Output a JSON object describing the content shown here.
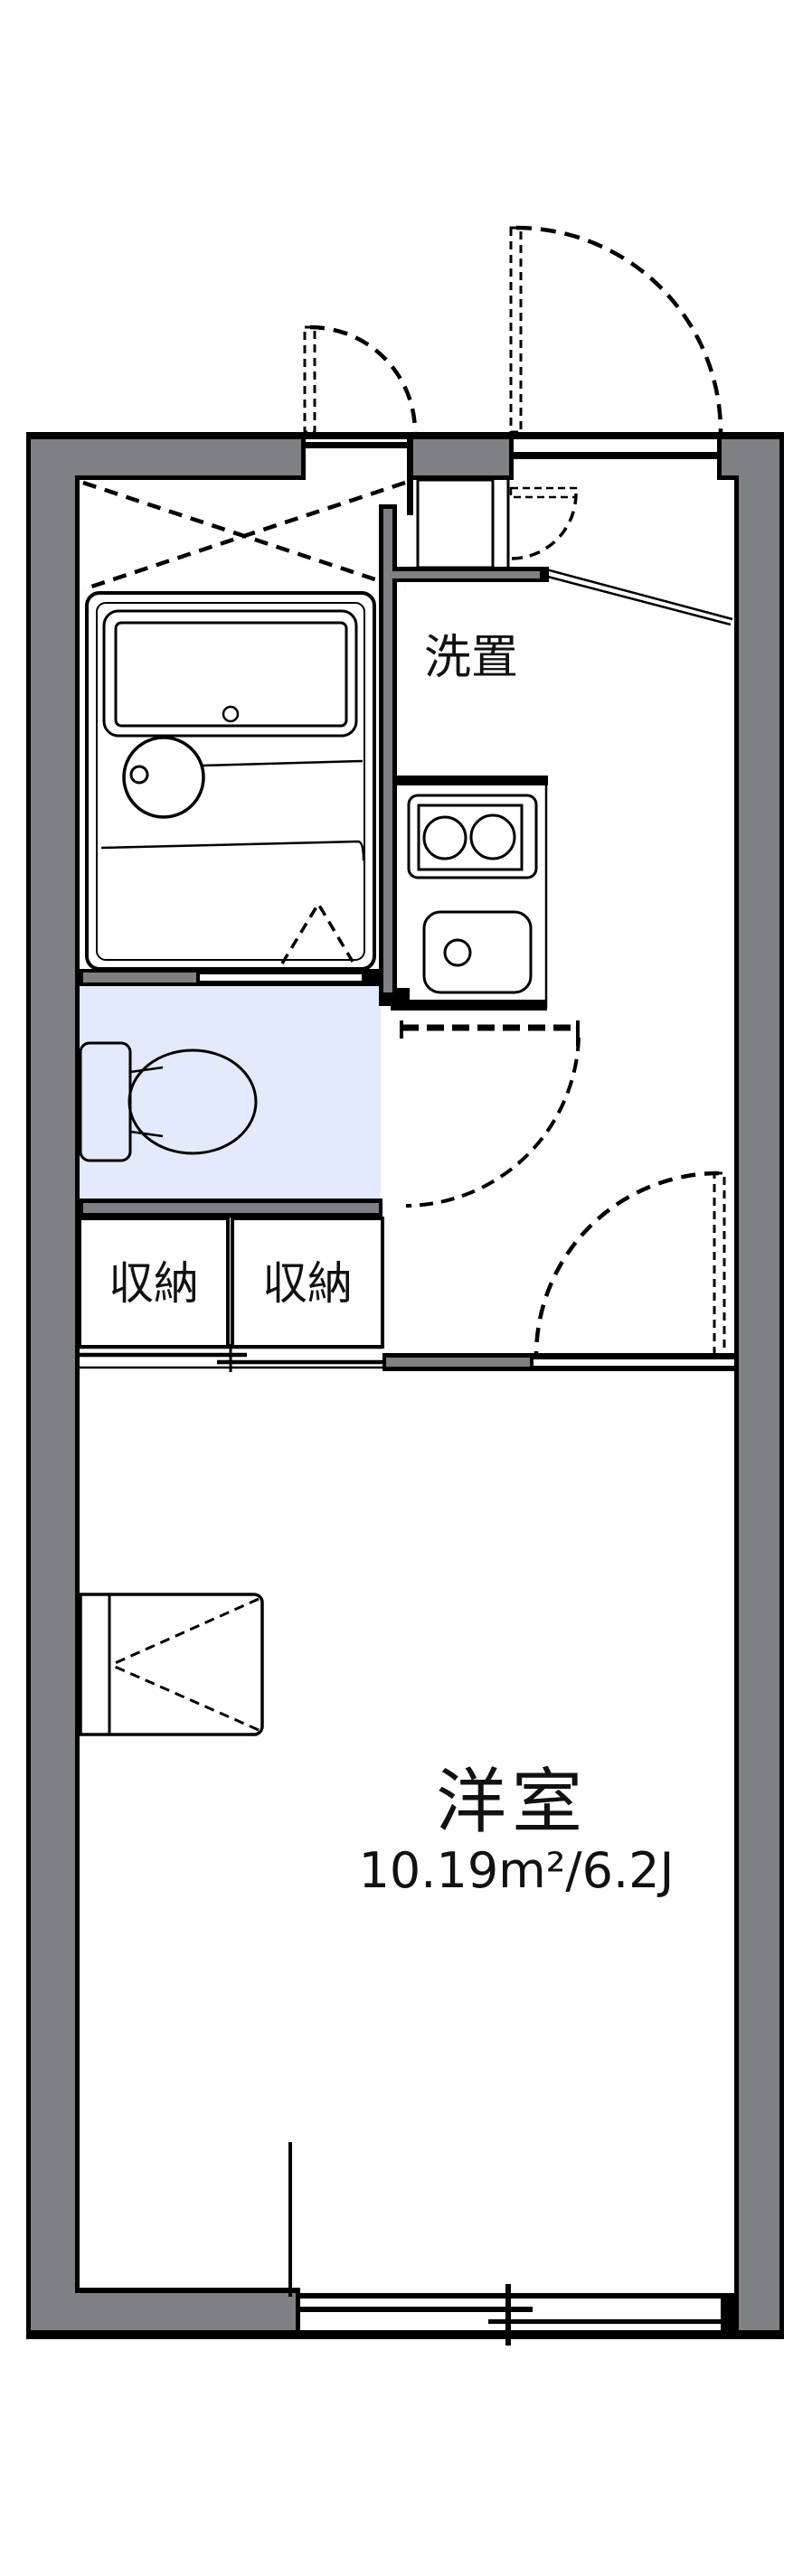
{
  "plan": {
    "type": "apartment-floor-plan",
    "layout": "1K"
  },
  "labels": {
    "washer": "洗置",
    "storage_left": "収納",
    "storage_right": "収納",
    "room_name": "洋室",
    "room_area": "10.19m²/6.2J"
  },
  "fixtures": [
    "bathtub-icon",
    "washbasin-icon",
    "toilet-icon",
    "gas-stove-icon",
    "kitchen-sink-icon",
    "washing-machine-space-icon",
    "desk-counter-icon",
    "entrance-door-swing-icon",
    "small-door-swing-icon",
    "hall-door-swing-icon",
    "room-door-swing-icon",
    "folding-bath-door-icon",
    "closet-sliding-door-icon",
    "sliding-window-icon"
  ],
  "colors": {
    "wall-color": "#7e8083",
    "water-color": "#e3eafb",
    "cream-color": "#fbf1de",
    "line-color": "#000000",
    "bg-color": "#ffffff"
  }
}
